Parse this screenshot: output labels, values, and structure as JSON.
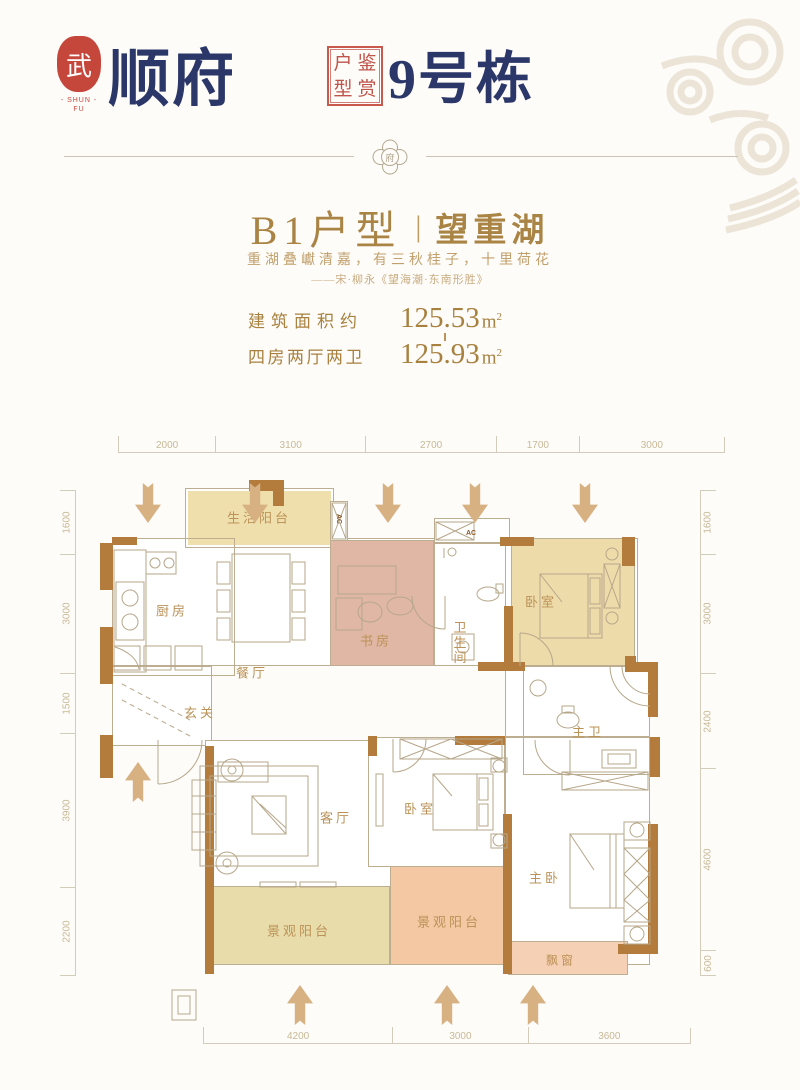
{
  "header": {
    "seal_char": "武",
    "seal_caption": "- SHUN -",
    "seal_caption2": "FU",
    "brand_name": "顺府",
    "stamp_chars": [
      "户",
      "鉴",
      "型",
      "赏"
    ],
    "building_label": "9号栋"
  },
  "divider": {
    "emblem_char": "府"
  },
  "intro": {
    "unit_title": "B1户型",
    "title_sep": "|",
    "view_title": "望重湖",
    "poem": "重湖叠巘清嘉，有三秋桂子，十里荷花",
    "poem_source": "——宋·柳永《望海潮·东南形胜》",
    "spec_rows": [
      {
        "label": "建筑面积约",
        "value": "125.53",
        "unit": "m",
        "sup": "2"
      },
      {
        "label": "四房两厅两卫",
        "value": "125.93",
        "unit": "m",
        "sup": "2"
      }
    ]
  },
  "floorplan": {
    "ac_label": "AC",
    "rooms": [
      {
        "label": "生活阳台"
      },
      {
        "label": "厨房"
      },
      {
        "label": "餐厅"
      },
      {
        "label": "书房"
      },
      {
        "label": "卫生间"
      },
      {
        "label": "卧室"
      },
      {
        "label": "玄关"
      },
      {
        "label": "客厅"
      },
      {
        "label": "卧室"
      },
      {
        "label": "主卫"
      },
      {
        "label": "主卧"
      },
      {
        "label": "景观阳台"
      },
      {
        "label": "景观阳台"
      },
      {
        "label": "飘窗"
      }
    ],
    "dims_top": [
      "2000",
      "3100",
      "2700",
      "1700",
      "3000"
    ],
    "dims_bottom": [
      "4200",
      "3000",
      "3600"
    ],
    "dims_left": [
      "1600",
      "3000",
      "1500",
      "3900",
      "2200"
    ],
    "dims_right": [
      "1600",
      "3000",
      "2400",
      "4600",
      "600"
    ]
  },
  "colors": {
    "navy": "#2b3768",
    "seal_red": "#c5473c",
    "gold": "#aa8445",
    "wall_brown": "#b47c3c",
    "tan_fill": "#efdfad",
    "salmon_fill": "#dfb5a3",
    "balcony_salmon": "#f2c5a2"
  }
}
